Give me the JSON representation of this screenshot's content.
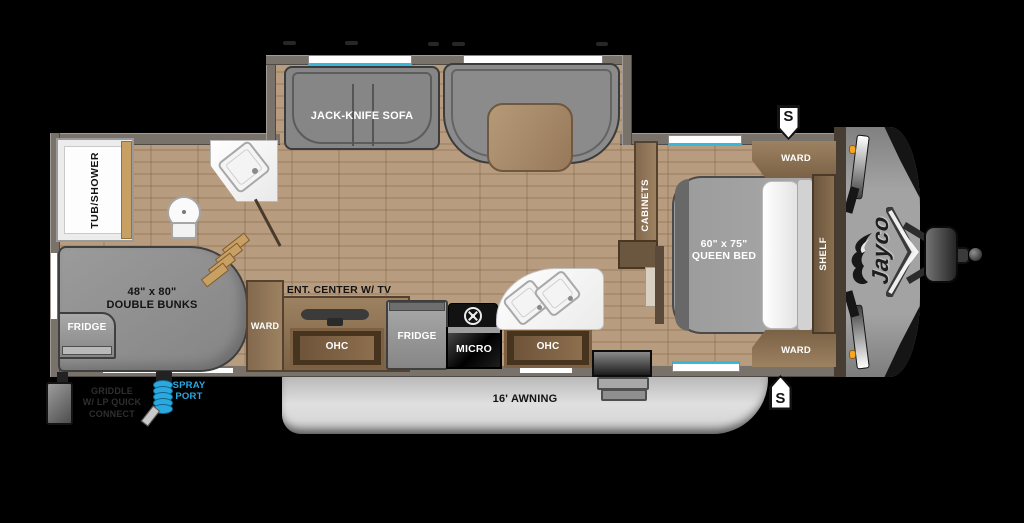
{
  "plan": {
    "brand_logo": "Jayco",
    "speaker_marker": "S",
    "living": {
      "sofa_label": "JACK-KNIFE SOFA",
      "ent_center_label": "ENT. CENTER W/ TV"
    },
    "bath": {
      "tub_label": "TUB/SHOWER"
    },
    "bedroom": {
      "bed_size": "60\" x 75\"",
      "bed_type": "QUEEN BED",
      "ward_top_label": "WARD",
      "ward_bottom_label": "WARD",
      "shelf_label": "SHELF",
      "cabinets_label": "CABINETS"
    },
    "bunk_room": {
      "bunk_size": "48\" x 80\"",
      "bunk_type": "DOUBLE BUNKS",
      "fridge_label": "FRIDGE"
    },
    "kitchen": {
      "ward_label": "WARD",
      "ohc_left_label": "OHC",
      "fridge_label": "FRIDGE",
      "micro_label": "MICRO",
      "ohc_right_label": "OHC"
    },
    "exterior": {
      "awning_label": "16' AWNING",
      "griddle_line1": "GRIDDLE",
      "griddle_line2": "W/ LP QUICK",
      "griddle_line3": "CONNECT",
      "spray_line1": "SPRAY",
      "spray_line2": "PORT"
    },
    "colors": {
      "accent_blue": "#39b7d8",
      "spray_blue": "#2aa9e0",
      "marker_orange": "#f5a623",
      "cabinet_brown": "#8d7458",
      "floor_wood": "#b79c7f",
      "wall_taupe": "#79726a"
    }
  }
}
